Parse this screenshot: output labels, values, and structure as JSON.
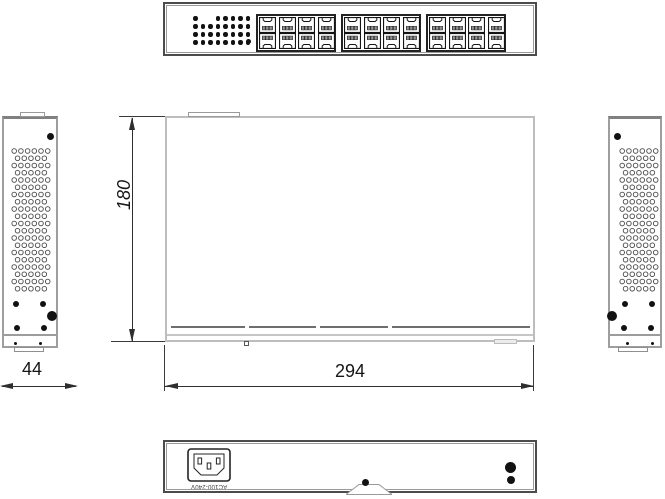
{
  "drawing": {
    "subject": "24-port network switch orthographic technical drawing",
    "colors": {
      "outline_dark": "#4c4c4c",
      "outline_mid": "#8f8f8f",
      "outline_light": "#bdbdbd",
      "ink": "#141414",
      "background": "#ffffff"
    },
    "dimensions": {
      "height": "180",
      "width": "294",
      "depth": "44"
    },
    "front_view": {
      "led_matrix": {
        "rows": 4,
        "cols": 8,
        "missing": [
          [
            0,
            1
          ],
          [
            0,
            2
          ]
        ]
      },
      "port_groups": 3,
      "port_rows": 2,
      "port_cols": 4
    },
    "side_view": {
      "vent_rows": 20,
      "vent_cols": 6
    },
    "rear_view": {
      "power_inlet_label": "AC100-240V"
    }
  }
}
